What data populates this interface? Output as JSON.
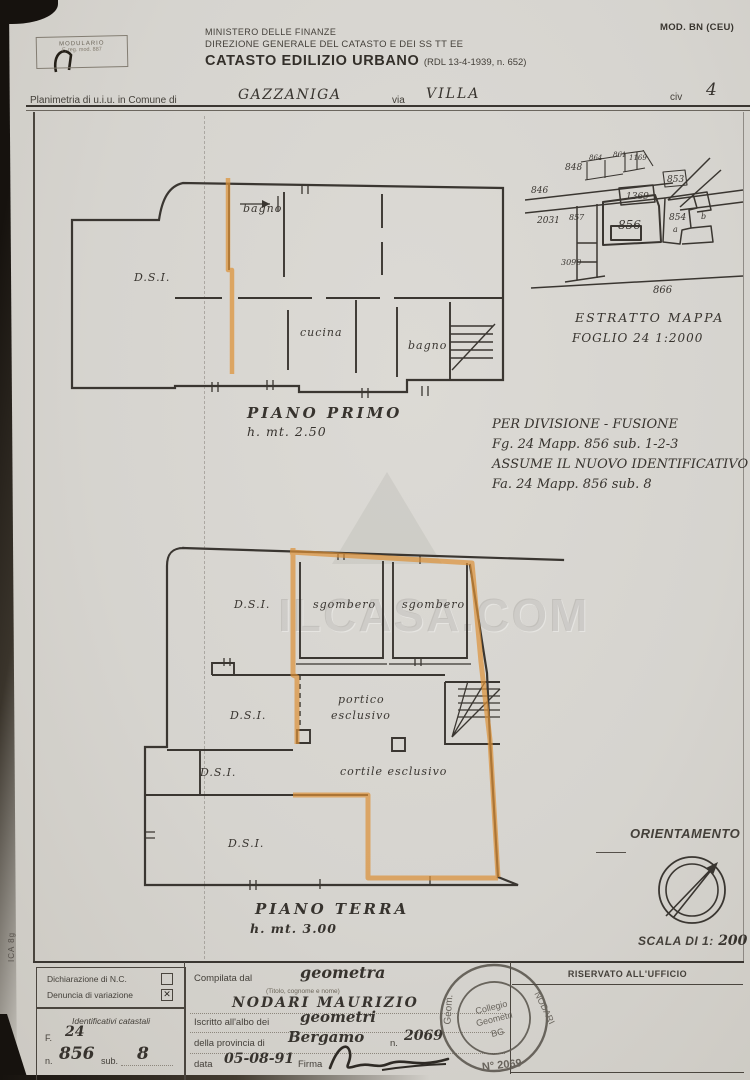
{
  "doc": {
    "mod_label": "MOD. BN (CEU)",
    "modulario_l1": "MODULARIO",
    "modulario_l2": "F. reg. mod. 887",
    "ministry1": "MINISTERO DELLE FINANZE",
    "ministry2": "DIREZIONE GENERALE DEL CATASTO E DEI SS TT EE",
    "title_bold": "CATASTO EDILIZIO URBANO",
    "title_ref": "(RDL 13-4-1939, n. 652)",
    "planimetria_label": "Planimetria di u.i.u. in Comune di",
    "comune": "GAZZANIGA",
    "via_label": "via",
    "via": "VILLA",
    "civ_label": "civ",
    "civ": "4",
    "side_note": "ICA 8g",
    "watermark": "ILCASA.COM"
  },
  "plan1": {
    "title": "PIANO PRIMO",
    "height": "h. mt. 2.50",
    "rooms": {
      "bagno_top": "bagno",
      "dsi": "D.S.I.",
      "cucina": "cucina",
      "bagno_right": "bagno"
    }
  },
  "map": {
    "caption_line1": "ESTRATTO   MAPPA",
    "caption_line2": "FOGLIO 24      1:2000",
    "parcels": {
      "p846": "846",
      "p848": "848",
      "p864": "864",
      "p861": "861",
      "p1169": "1169",
      "p853": "853",
      "p1369": "1369",
      "p2031": "2031",
      "p857": "857",
      "p856": "856",
      "p854": "854",
      "pa": "a",
      "pb": "b",
      "p3090": "3090",
      "p866": "866"
    }
  },
  "annotation": {
    "l1": "PER DIVISIONE - FUSIONE",
    "l2": "Fg. 24    Mapp. 856  sub.  1-2-3",
    "l3": "ASSUME IL NUOVO IDENTIFICATIVO",
    "l4": "Fa. 24    Mapp. 856  sub.  8"
  },
  "plan2": {
    "title": "PIANO TERRA",
    "height": "h. mt. 3.00",
    "rooms": {
      "dsi1": "D.S.I.",
      "sgombero1": "sgombero",
      "sgombero2": "sgombero",
      "dsi2": "D.S.I.",
      "portico1": "portico",
      "portico2": "esclusivo",
      "dsi3": "D.S.I.",
      "cortile": "cortile   esclusivo",
      "dsi4": "D.S.I."
    }
  },
  "orientation": {
    "label": "ORIENTAMENTO",
    "scale_label": "SCALA DI 1:",
    "scale_value": "200"
  },
  "form": {
    "declaration1": "Dichiarazione di N.C.",
    "declaration2": "Denuncia di variazione",
    "checkbox2_mark": "✕",
    "ident_title": "Identificativi catastali",
    "f_label": "F.",
    "f_value": "24",
    "n_label": "n.",
    "n_value": "856",
    "sub_label": "sub.",
    "sub_value": "8",
    "compilata_label": "Compilata dal",
    "compilata_value": "geometra",
    "titolo_hint": "(Titolo, cognome e nome)",
    "name": "NODARI   MAURIZIO",
    "iscritto_label": "Iscritto all'albo dei",
    "iscritto_value": "geometri",
    "provincia_label": "della provincia di",
    "provincia_value": "Bergamo",
    "num_label": "n.",
    "num_value": "2069",
    "data_label": "data",
    "data_value": "05-08-91",
    "firma_label": "Firma",
    "riservato": "RISERVATO ALL'UFFICIO",
    "stamp": {
      "t1": "Geom.",
      "t2": "NODARI",
      "c1": "Collegio",
      "c2": "Geometri",
      "c3": "BG",
      "n": "N° 2069"
    }
  }
}
